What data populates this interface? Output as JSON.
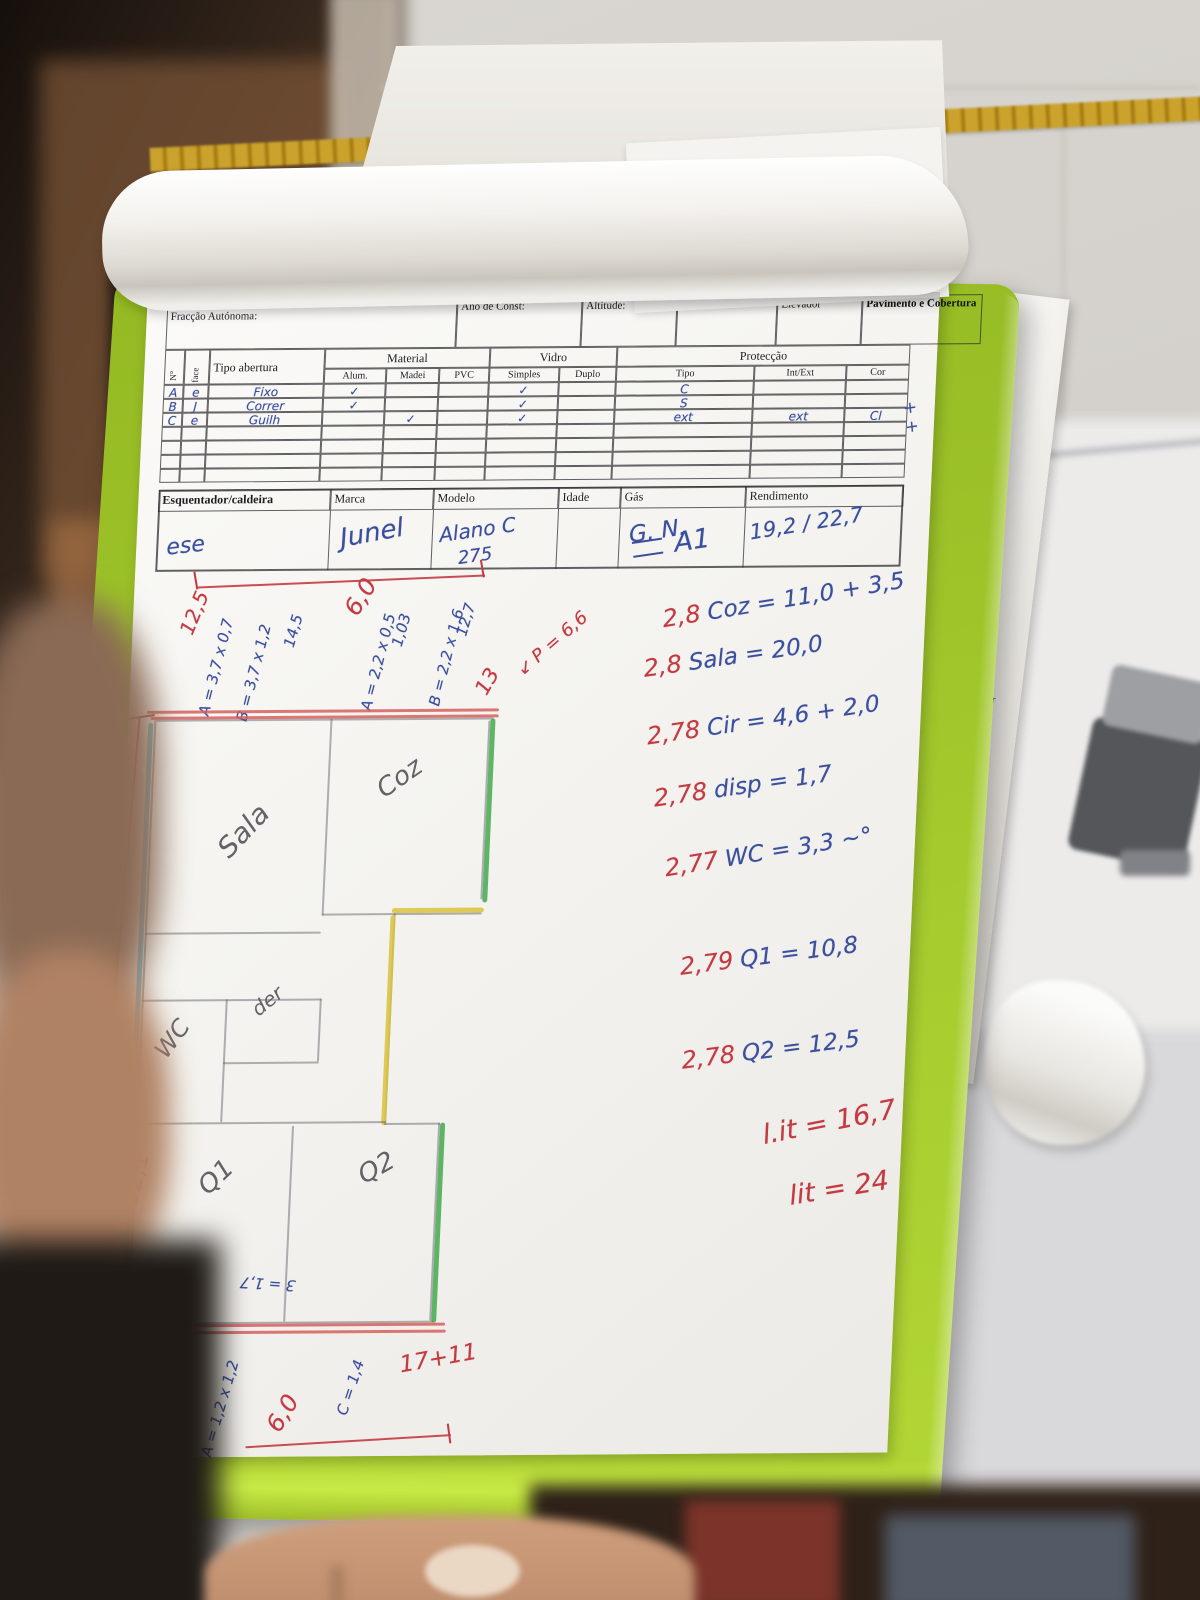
{
  "colors": {
    "board_green": "#a2c52c",
    "board_edge": "#c8ea45",
    "red_ink": "#c43a42",
    "blue_ink": "#3a4f9e",
    "cyan_crayon": "#62b8d0",
    "green_crayon": "#43a94e",
    "yellow_crayon": "#d9c23b",
    "paper": "#f6f5f2"
  },
  "back_sheet": {
    "note1": "ambos guardar",
    "note2": "ModeDecPropCart v.1",
    "digits": "3 3 50"
  },
  "form": {
    "scribble": "Buach Olago",
    "fields": [
      "Fracção Autónoma:",
      "Ano de Const:",
      "Altitude:",
      "Pré.Frente?",
      "Elevador",
      "Pavimento e Cobertura"
    ],
    "table": {
      "n": "N°",
      "face": "face",
      "tipo": "Tipo abertura",
      "groups": [
        "Material",
        "Vidro",
        "Protecção"
      ],
      "sub": [
        "Alum.",
        "Madei",
        "PVC",
        "Simples",
        "Duplo",
        "Tipo",
        "Int/Ext",
        "Cor"
      ],
      "rows": [
        [
          "A",
          "e",
          "Fixo",
          "✓",
          "",
          "",
          "✓",
          "",
          "C",
          "",
          ""
        ],
        [
          "B",
          "J",
          "Correr",
          "✓",
          "",
          "",
          "✓",
          "",
          "S",
          "",
          ""
        ],
        [
          "C",
          "e",
          "Guilh",
          "",
          "✓",
          "",
          "✓",
          "",
          "ext",
          "ext",
          "Cl"
        ],
        [
          "",
          "",
          "",
          "",
          "",
          "",
          "",
          "",
          "",
          "",
          ""
        ],
        [
          "",
          "",
          "",
          "",
          "",
          "",
          "",
          "",
          "",
          "",
          ""
        ],
        [
          "",
          "",
          "",
          "",
          "",
          "",
          "",
          "",
          "",
          "",
          ""
        ],
        [
          "",
          "",
          "",
          "",
          "",
          "",
          "",
          "",
          "",
          "",
          ""
        ]
      ],
      "margin_note": "+ +"
    },
    "heater": {
      "headers": [
        "Esquentador/caldeira",
        "Marca",
        "Modelo",
        "Idade",
        "Gás",
        "Rendimento"
      ],
      "values": {
        "tipo": "ese",
        "marca": "Junel",
        "modelo": "Alano C",
        "modelo2": "275",
        "gas": "G. N.",
        "rendimento": "19,2 / 22,7"
      }
    }
  },
  "notes": {
    "a1": "A1",
    "calcs": [
      {
        "h": "2,8",
        "t": "Coz = 11,0 + 3,5"
      },
      {
        "h": "2,8",
        "t": "Sala = 20,0"
      },
      {
        "h": "2,78",
        "t": "Cir = 4,6 + 2,0"
      },
      {
        "h": "2,78",
        "t": "disp = 1,7"
      },
      {
        "h": "2,77",
        "t": "WC = 3,3 ~°"
      },
      {
        "h": "2,79",
        "t": "Q1 = 10,8"
      },
      {
        "h": "2,78",
        "t": "Q2 = 12,5"
      }
    ],
    "totals": [
      "l.it = 16,7",
      "lit = 24"
    ]
  },
  "plan": {
    "rooms": {
      "sala": "Sala",
      "coz": "Coz",
      "wc": "WC",
      "disp": "der",
      "q1": "Q1",
      "q2": "Q2"
    },
    "top_dim": "6,0",
    "left_dim": "12,1",
    "bottom_dim": "6,0",
    "bottom_sum": "17+11",
    "perimeter": "P = 6,6",
    "side_measures": [
      "12,5",
      "A = 3,7 x 0,7",
      "B = 3,7 x 1,2",
      "14,5",
      "A = 2,2 x 0,5",
      "1,03",
      "B = 2,2 x 1,6",
      "12,7",
      "13"
    ],
    "bottom_measures": [
      "2 = 1,7",
      "3 = 1,7",
      "C = 1,4",
      "A = 1,2 x 1,2",
      "1,4"
    ]
  }
}
